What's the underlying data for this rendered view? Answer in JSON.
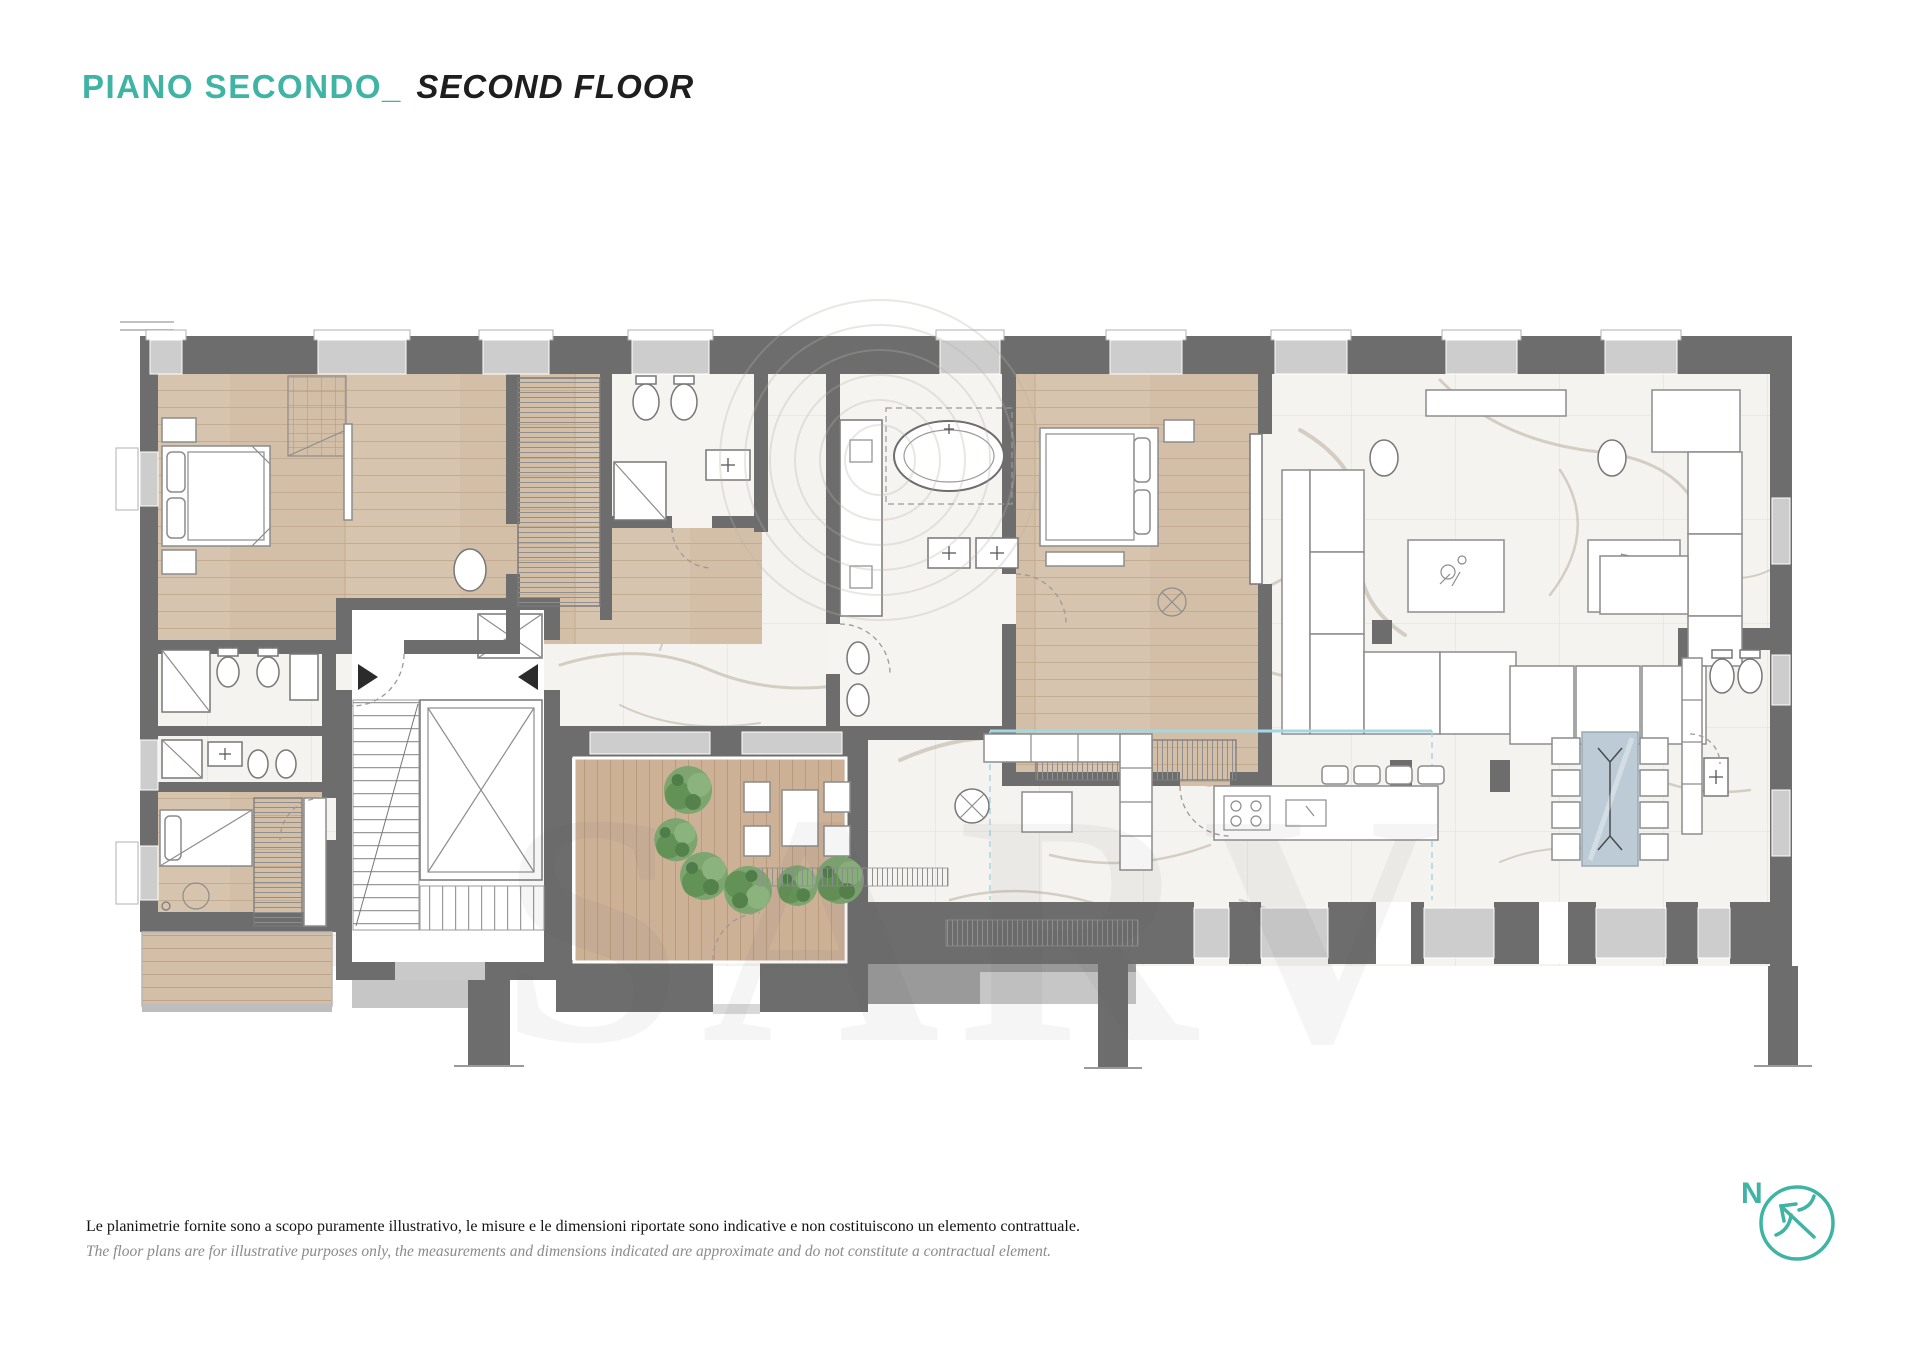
{
  "header": {
    "title_it": "PIANO SECONDO",
    "title_sep": "_",
    "title_en": "SECOND FLOOR"
  },
  "footer": {
    "disclaimer_it": "Le planimetrie fornite sono a scopo puramente illustrativo, le misure e le dimensioni riportate sono indicative e non costituiscono un elemento contrattuale.",
    "disclaimer_en": "The floor plans are for illustrative purposes only, the measurements and dimensions indicated are approximate and do not constitute a contractual element."
  },
  "compass": {
    "label": "N",
    "direction": "north-west"
  },
  "watermark": {
    "text": "SARV"
  },
  "colors": {
    "accent_teal": "#3FB3A4",
    "text_dark": "#1E1E1E",
    "text_muted": "#8A8A8A",
    "wall_dark": "#6D6D6D",
    "wall_medium": "#9A9A9A",
    "window_gray": "#CDCDCD",
    "wood_floor": "#D7C4AE",
    "wood_deck": "#CEB298",
    "marble": "#F5F3EF",
    "vein": "#B3A896",
    "glass_blue": "#A5D6E2",
    "table_glass": "#BCCBD6",
    "plant_dark": "#4F7D49",
    "plant_light": "#7FA873"
  }
}
